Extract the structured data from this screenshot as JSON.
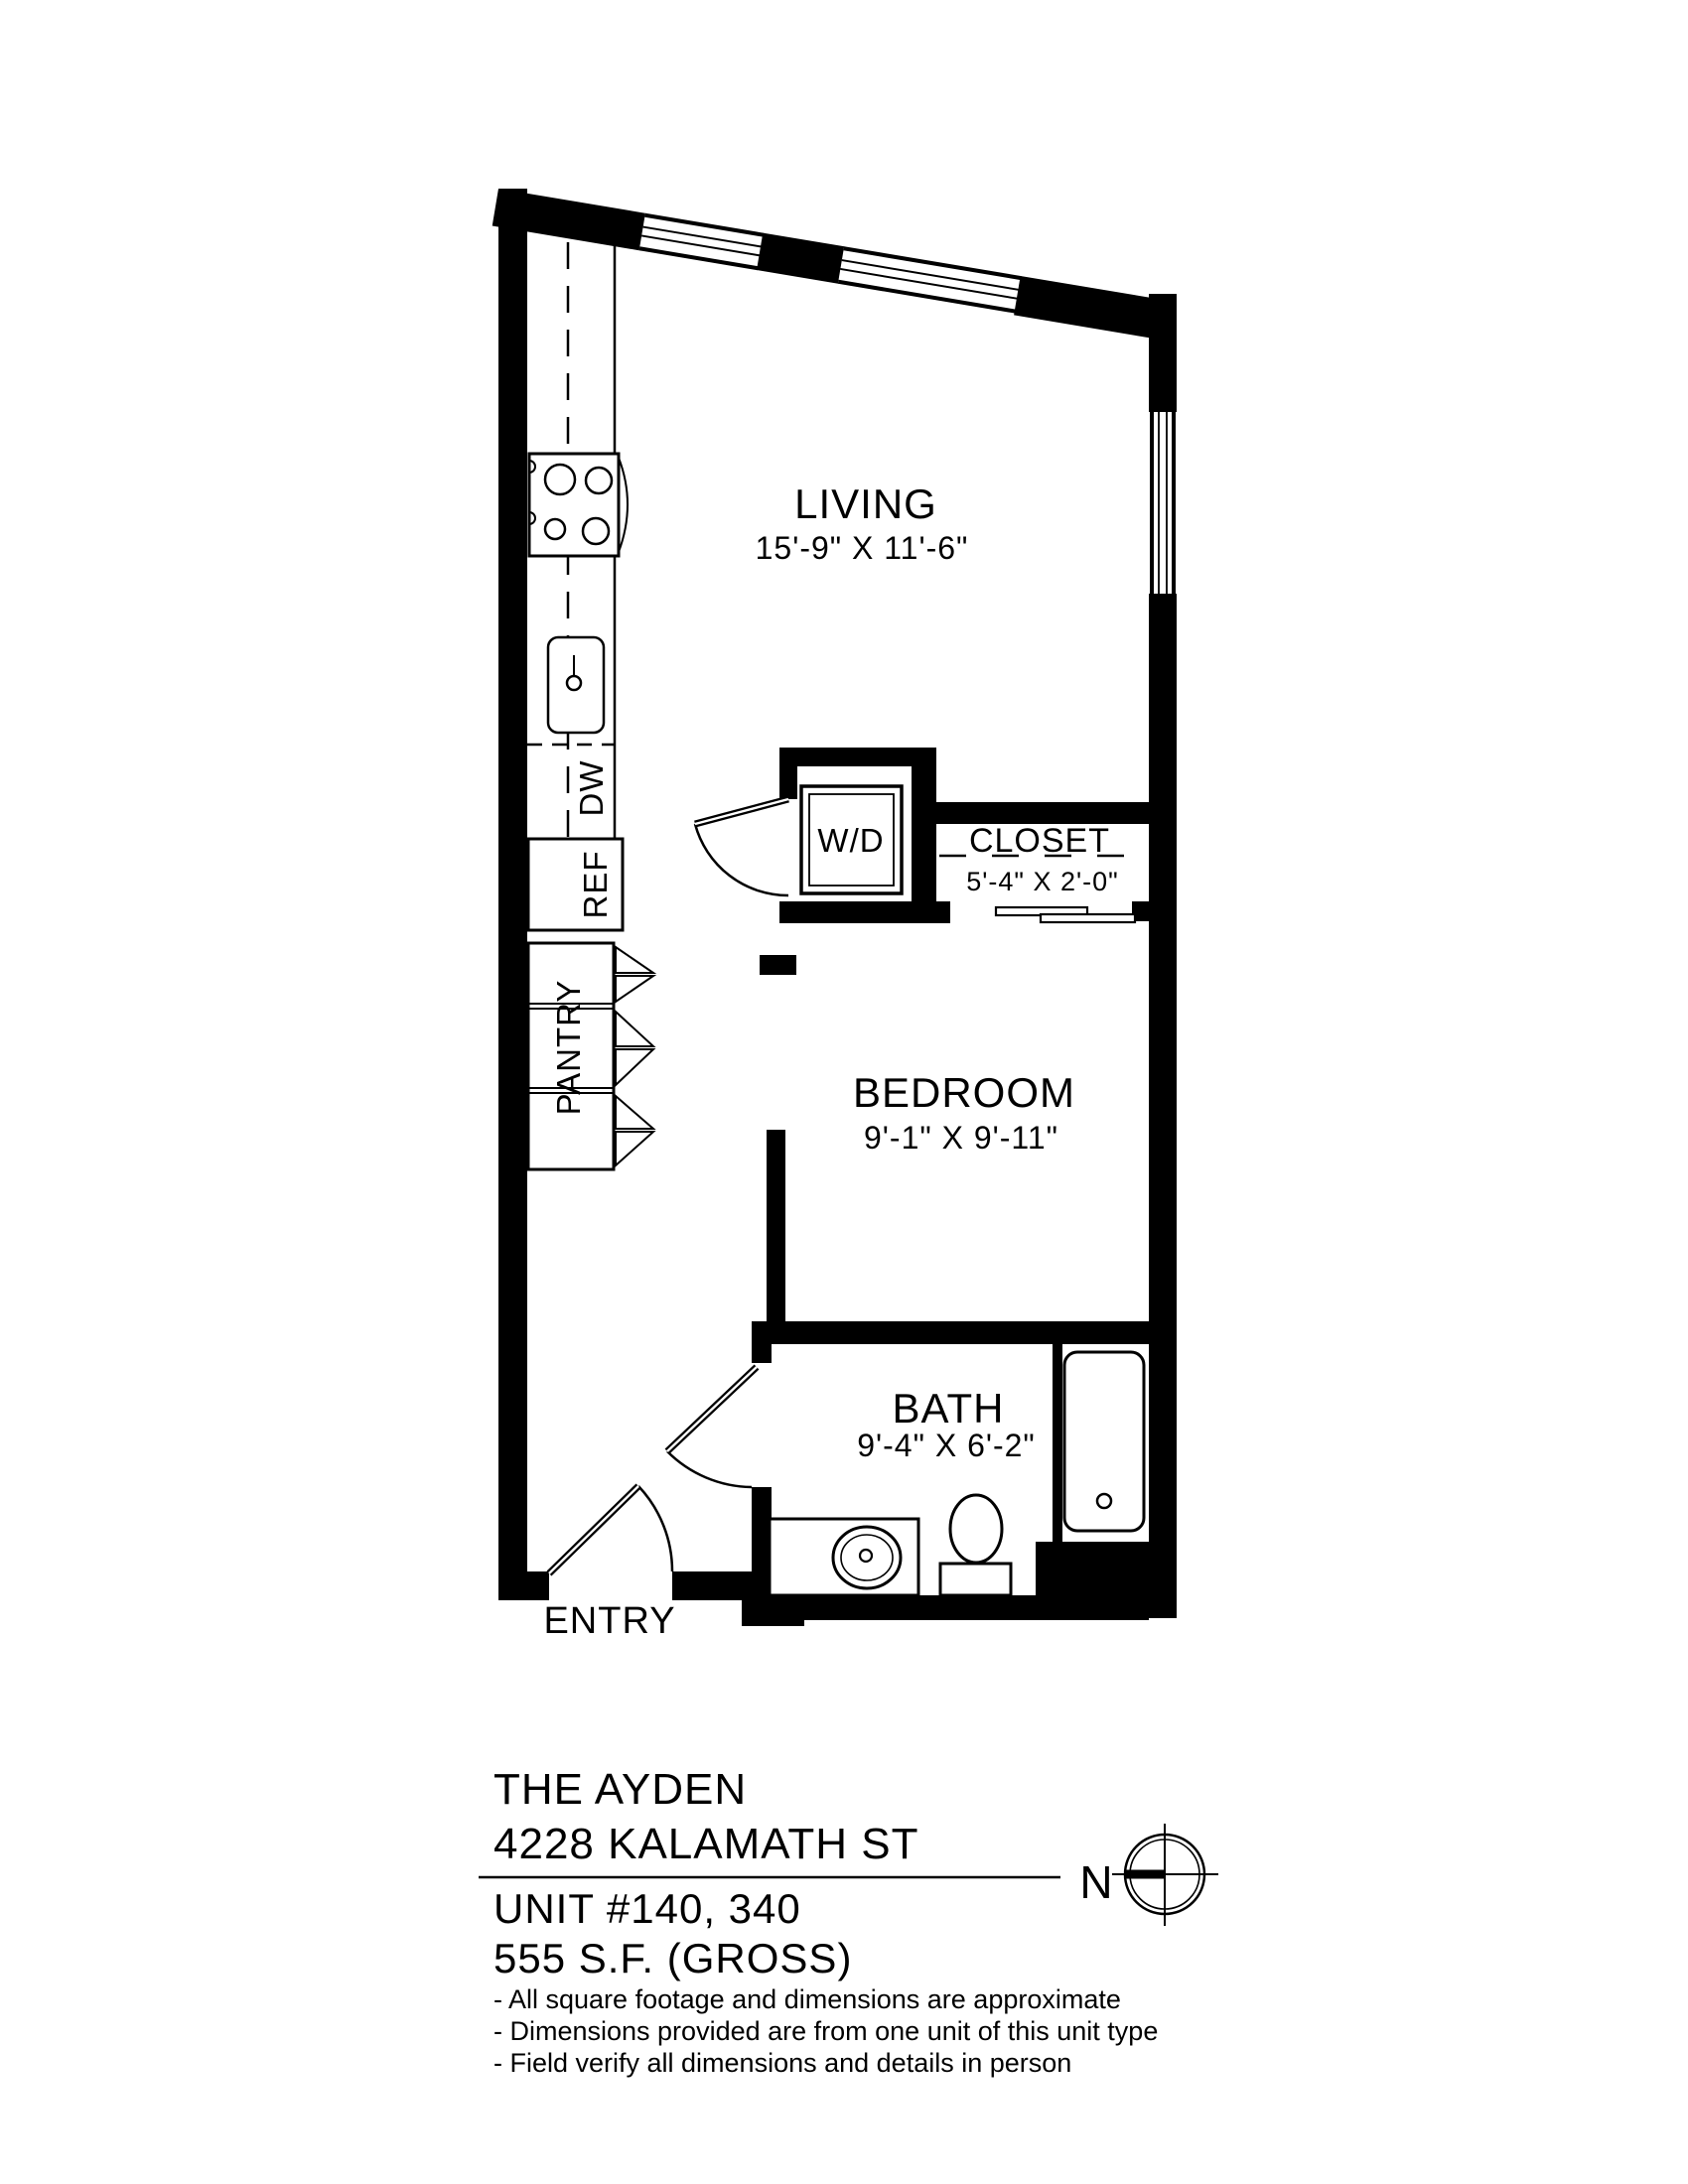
{
  "plan": {
    "rooms": {
      "living": {
        "name": "LIVING",
        "dims": "15'-9\" X 11'-6\""
      },
      "bedroom": {
        "name": "BEDROOM",
        "dims": "9'-1\" X 9'-11\""
      },
      "bath": {
        "name": "BATH",
        "dims": "9'-4\" X 6'-2\""
      },
      "closet": {
        "name": "CLOSET",
        "dims": "5'-4\" X 2'-0\""
      },
      "entry": {
        "name": "ENTRY"
      }
    },
    "labels": {
      "washer_dryer": "W/D",
      "dishwasher": "DW",
      "refrigerator": "REF",
      "pantry": "PANTRY"
    }
  },
  "title_block": {
    "building_name": "THE AYDEN",
    "address": "4228 KALAMATH ST",
    "unit": "UNIT #140, 340",
    "area": "555 S.F. (GROSS)",
    "notes": [
      "- All square footage and dimensions are approximate",
      "- Dimensions provided are from one unit of this unit type",
      "- Field verify all dimensions and details in person"
    ]
  },
  "compass": {
    "north_label": "N"
  },
  "colors": {
    "ink": "#000000",
    "paper": "#ffffff"
  }
}
